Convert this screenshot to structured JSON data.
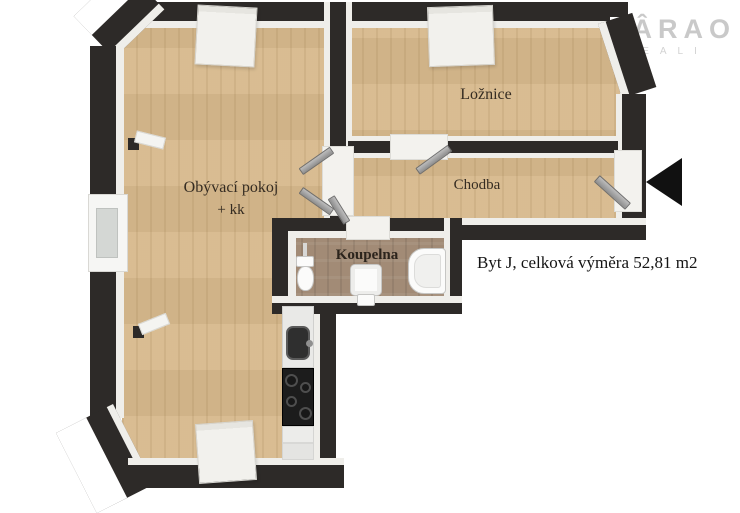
{
  "watermark": {
    "line1": "FÂRAO",
    "line2": "REALI"
  },
  "area_label": "Byt J, celková výměra  52,81 m2",
  "rooms": {
    "living": {
      "name": "Obývací pokoj",
      "suffix": "+ kk"
    },
    "bedroom": {
      "name": "Ložnice"
    },
    "hallway": {
      "name": "Chodba"
    },
    "bathroom": {
      "name": "Koupelna"
    }
  },
  "colors": {
    "wall": "#2d2a28",
    "wood_floor": "#d7b98c",
    "tile_floor": "#a28b76",
    "wall_lining": "#efeeea",
    "door": "#a8a8a8",
    "entrance_arrow": "#111111",
    "logo": "#c9c9c9",
    "background": "#ffffff"
  }
}
